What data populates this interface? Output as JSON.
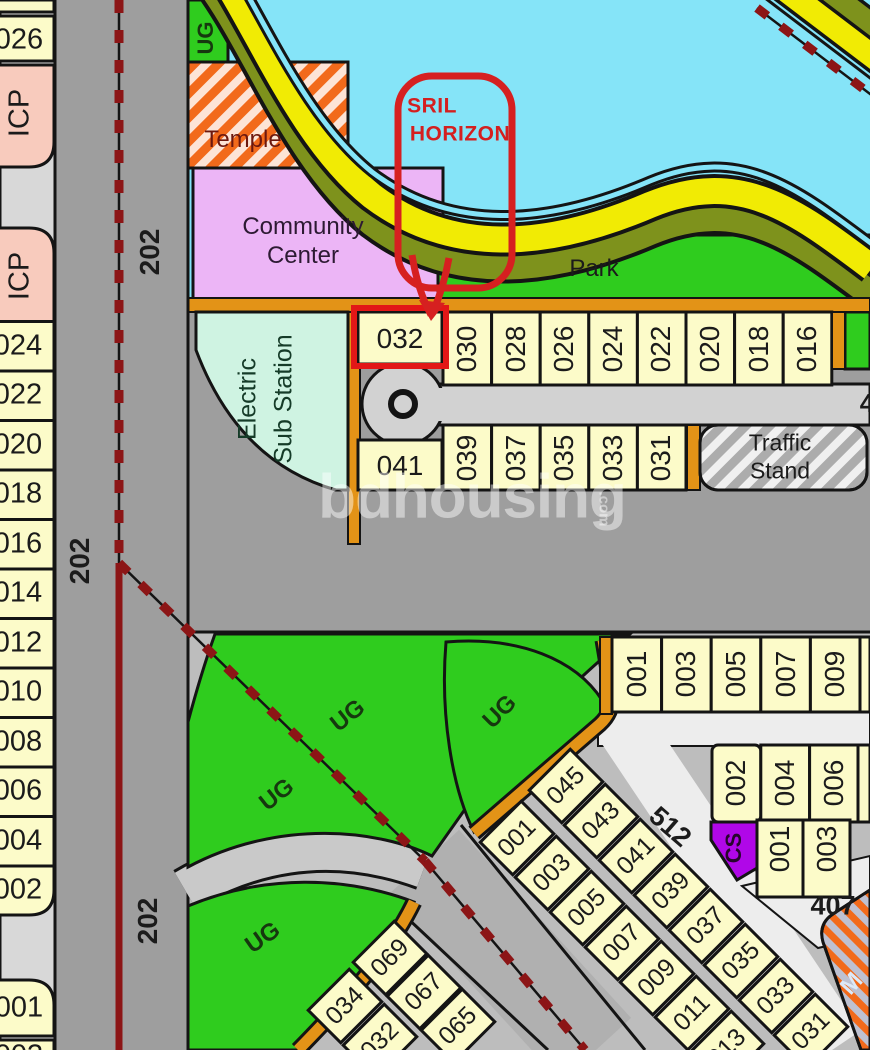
{
  "map": {
    "watermark": {
      "brand": "bdhousing",
      "tld": ".com"
    },
    "annotation": {
      "line1": "SRIL",
      "line2": "HORIZON",
      "target_plot": "032"
    },
    "areas": {
      "temple": "Temple",
      "community_line1": "Community",
      "community_line2": "Center",
      "park": "Park",
      "substation_line1": "Electric",
      "substation_line2": "Sub Station",
      "traffic_line1": "Traffic",
      "traffic_line2": "Stand",
      "ug_label": "UG",
      "cs_label": "CS",
      "mosque_partial": "M"
    },
    "roads": {
      "r202": "202",
      "r512": "512",
      "r407": "407",
      "partial_right": "4"
    },
    "left_column": [
      "026",
      "ICP",
      "ICP",
      "024",
      "022",
      "020",
      "018",
      "016",
      "014",
      "012",
      "010",
      "008",
      "006",
      "004",
      "002",
      "001",
      "003"
    ],
    "row_top": [
      "032",
      "030",
      "028",
      "026",
      "024",
      "022",
      "020",
      "018",
      "016"
    ],
    "row_bottom": [
      "041",
      "039",
      "037",
      "035",
      "033",
      "031"
    ],
    "col_right": [
      "001",
      "003",
      "005",
      "007",
      "009"
    ],
    "block_even": [
      "002",
      "004",
      "006"
    ],
    "block_odd": [
      "001",
      "003"
    ],
    "diag_a": [
      "001",
      "003",
      "005",
      "007",
      "009",
      "011",
      "013"
    ],
    "diag_b": [
      "045",
      "043",
      "041",
      "039",
      "037",
      "035",
      "033",
      "031"
    ],
    "diag_c": [
      "034",
      "032"
    ],
    "diag_d": [
      "069",
      "067",
      "065"
    ],
    "colors": {
      "lake": "#85E4F8",
      "park_green": "#2FCC1E",
      "plot_yellow": "#FCFBC9",
      "road_gray": "#9E9E9E",
      "orange_border": "#E39317",
      "temple_orange": "#F26A1B",
      "community_purple": "#ECB5F6",
      "substation_mint": "#CFF3E2",
      "boundary_red": "#8C1516",
      "annotation_red": "#D62020",
      "cs_purple": "#B007E8",
      "icp_pink": "#F8CBBD",
      "band_yellow": "#F1EB04",
      "band_olive": "#7E921C"
    }
  }
}
